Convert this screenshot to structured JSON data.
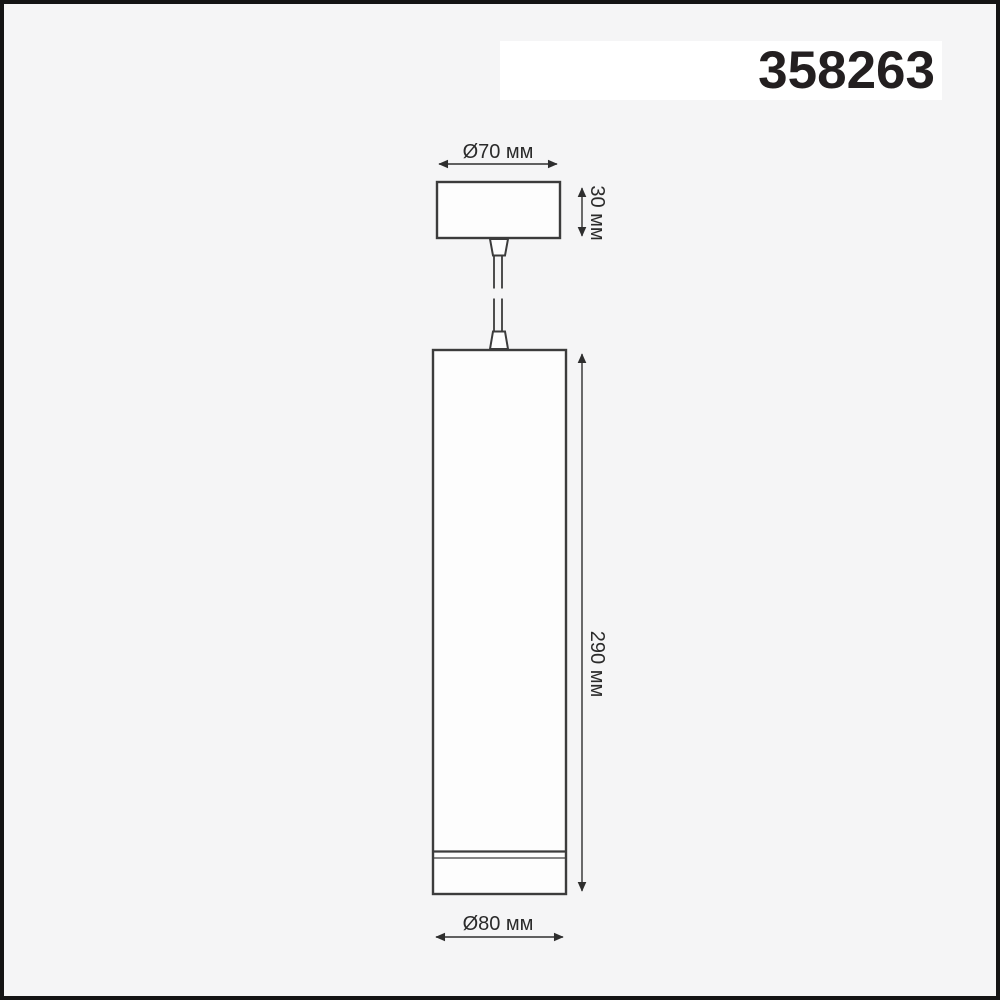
{
  "header": {
    "product_code": "358263"
  },
  "drawing": {
    "type": "technical-dimension-drawing",
    "subject": "pendant-lamp-cylinder",
    "labels": {
      "top_diameter": "Ø70 мм",
      "canopy_height": "30 мм",
      "body_height": "290 мм",
      "bottom_diameter": "Ø80 мм"
    },
    "dimensions_mm": {
      "canopy_diameter": 70,
      "canopy_height": 30,
      "body_height": 290,
      "body_diameter": 80
    },
    "colors": {
      "background": "#f5f5f6",
      "frame": "#141414",
      "banner_background": "#ffffff",
      "line": "#3c3c3c",
      "dimension_line": "#2e2e2e",
      "text": "#2b2b2b",
      "code_text": "#231f20"
    }
  }
}
